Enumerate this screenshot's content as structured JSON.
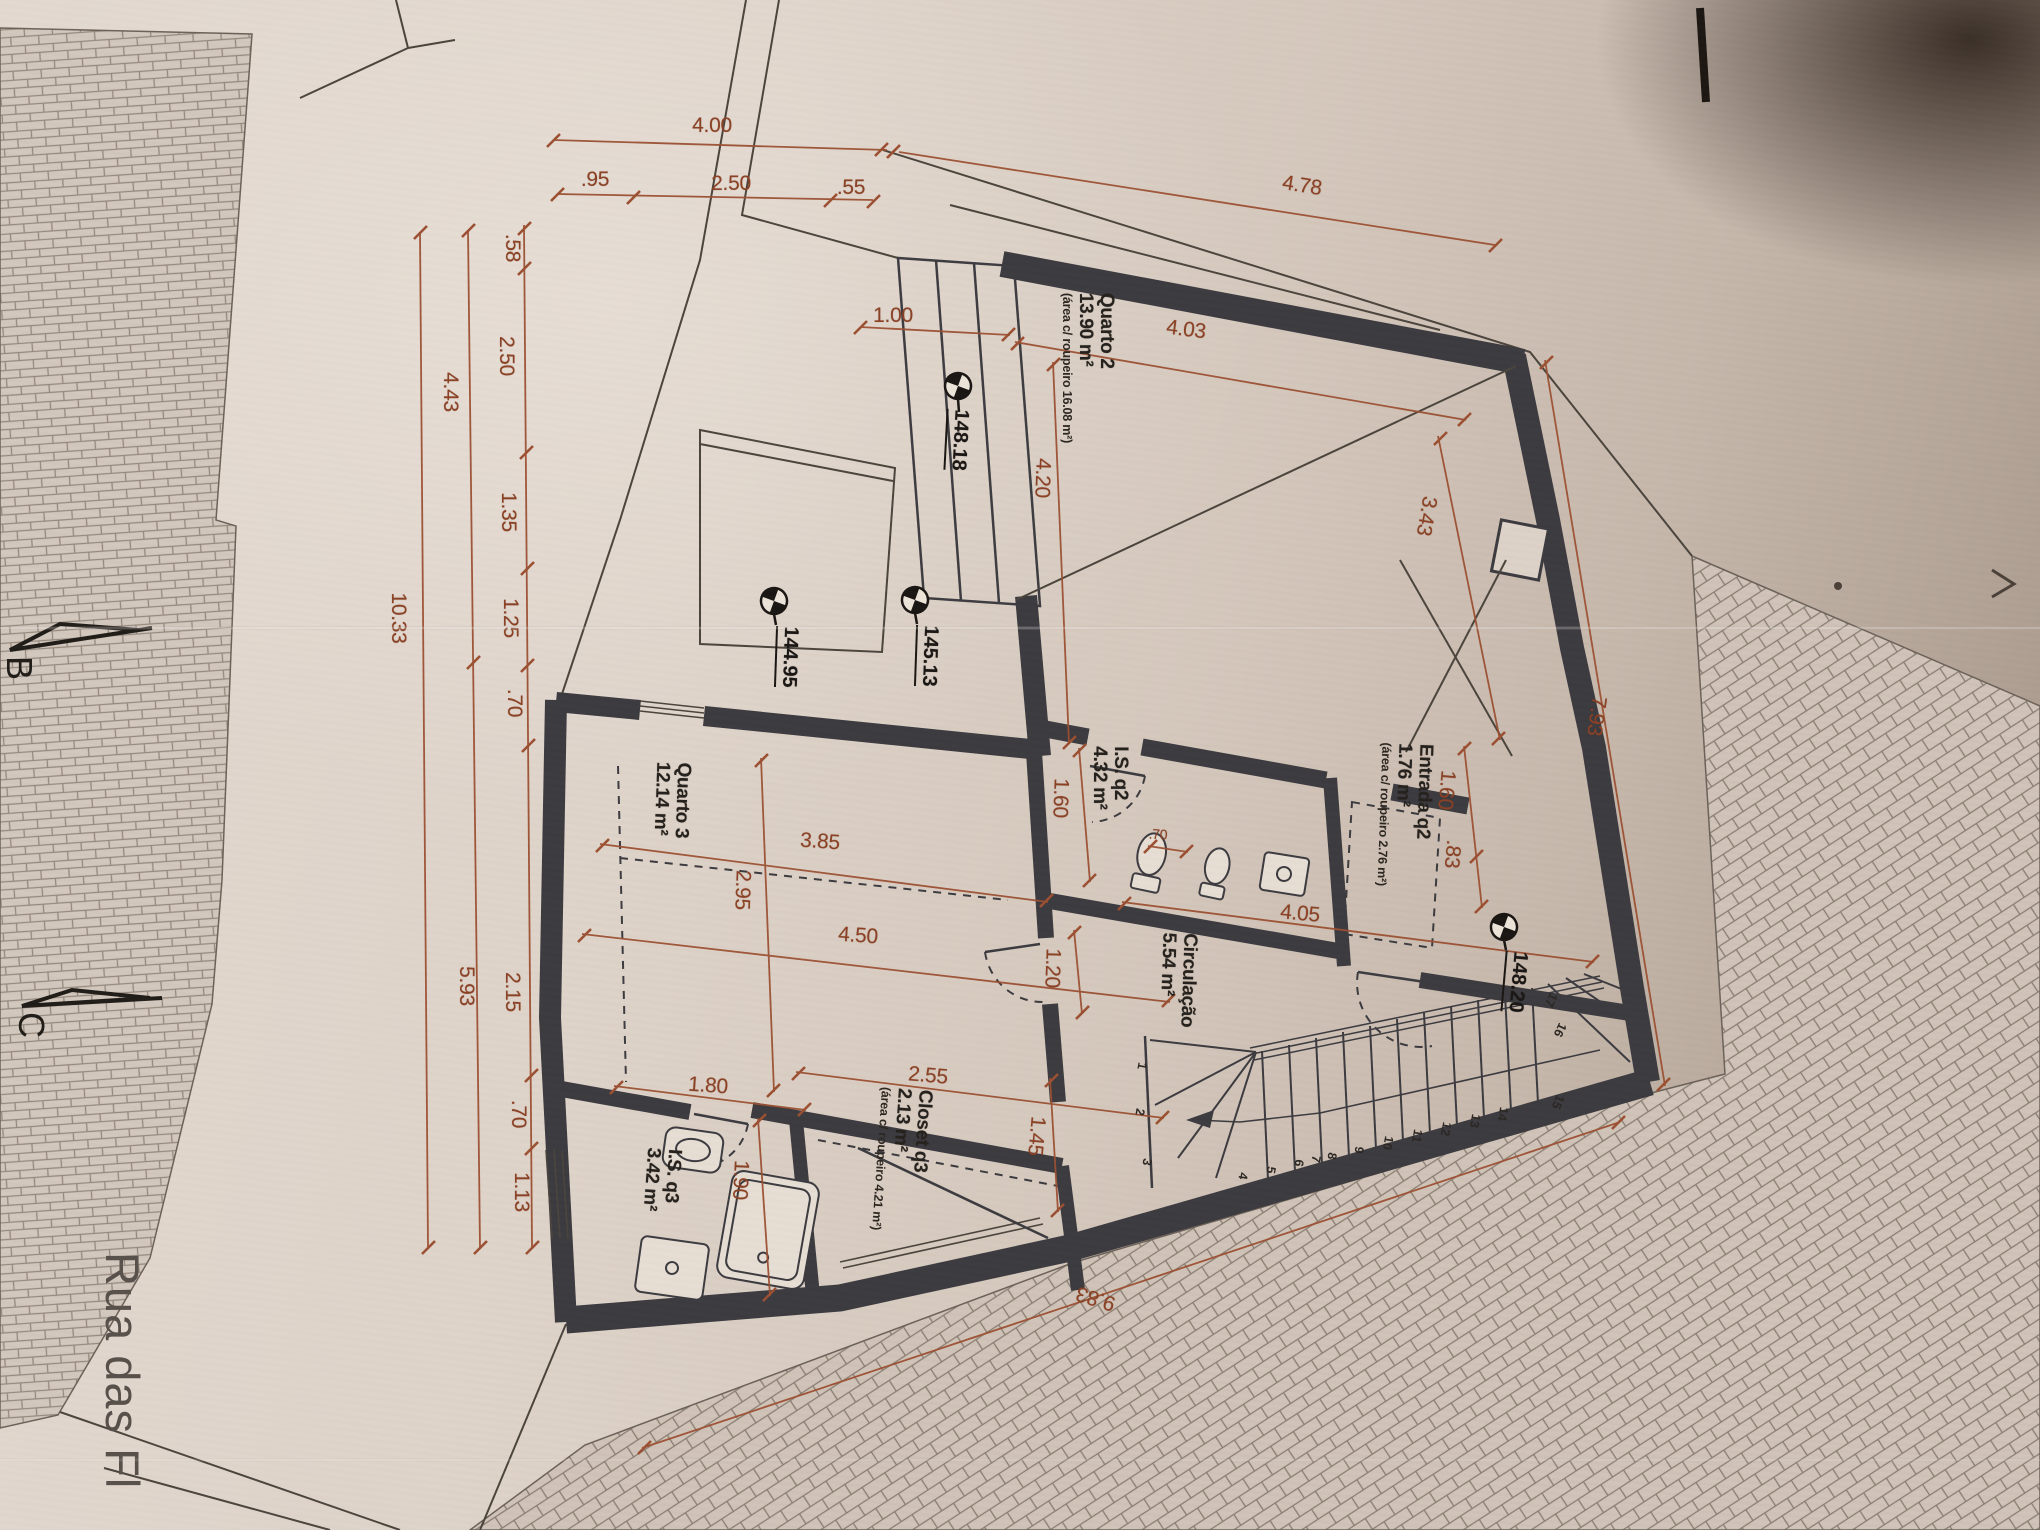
{
  "plan": {
    "street": {
      "label": "Rua das Fl"
    },
    "section_markers": [
      {
        "label": "B"
      },
      {
        "label": "C"
      }
    ],
    "rooms": [
      {
        "name": "Quarto 2",
        "area": "13.90 m²",
        "note": "(área c/ roupeiro 16.08 m²)",
        "x": 1088,
        "y": 368,
        "r": 90
      },
      {
        "name": "I.S. q2",
        "area": "4.32 m²",
        "x": 1110,
        "y": 778,
        "r": 90
      },
      {
        "name": "Entrada q2",
        "area": "1.76 m²",
        "note": "(área c/ roupeiro 2.76 m²)",
        "x": 1405,
        "y": 815,
        "r": 92
      },
      {
        "name": "Quarto 3",
        "area": "12.14 m²",
        "x": 672,
        "y": 800,
        "r": 92
      },
      {
        "name": "Circulação",
        "area": "5.54 m²",
        "x": 1178,
        "y": 980,
        "r": 92
      },
      {
        "name": "Closet q3",
        "area": "2.13 m²",
        "note": "(área c/ roupeiro 4.21 m²)",
        "x": 902,
        "y": 1160,
        "r": 94
      },
      {
        "name": "I.S. q3",
        "area": "3.42 m²",
        "x": 662,
        "y": 1180,
        "r": 94
      }
    ],
    "dimensions": [
      {
        "t": "4.00",
        "x": 712,
        "y": 126,
        "r": 0
      },
      {
        "t": ".95",
        "x": 595,
        "y": 180,
        "r": 0
      },
      {
        "t": "2.50",
        "x": 731,
        "y": 184,
        "r": 0
      },
      {
        "t": ".55",
        "x": 851,
        "y": 188,
        "r": 0
      },
      {
        "t": "4.78",
        "x": 1302,
        "y": 186,
        "r": 9
      },
      {
        "t": ".58",
        "x": 512,
        "y": 248,
        "r": 90
      },
      {
        "t": "2.50",
        "x": 506,
        "y": 356,
        "r": 90
      },
      {
        "t": "1.35",
        "x": 508,
        "y": 512,
        "r": 90
      },
      {
        "t": "1.25",
        "x": 510,
        "y": 618,
        "r": 90
      },
      {
        "t": ".70",
        "x": 514,
        "y": 703,
        "r": 90
      },
      {
        "t": "2.15",
        "x": 512,
        "y": 992,
        "r": 90
      },
      {
        "t": ".70",
        "x": 518,
        "y": 1114,
        "r": 90
      },
      {
        "t": "1.13",
        "x": 521,
        "y": 1192,
        "r": 90
      },
      {
        "t": "4.43",
        "x": 450,
        "y": 392,
        "r": 90
      },
      {
        "t": "5.93",
        "x": 466,
        "y": 986,
        "r": 90
      },
      {
        "t": "10.33",
        "x": 398,
        "y": 618,
        "r": 90
      },
      {
        "t": "1.00",
        "x": 893,
        "y": 316,
        "r": 0
      },
      {
        "t": "4.03",
        "x": 1186,
        "y": 330,
        "r": 7
      },
      {
        "t": "4.20",
        "x": 1042,
        "y": 478,
        "r": 92
      },
      {
        "t": "3.43",
        "x": 1426,
        "y": 516,
        "r": 100
      },
      {
        "t": "7.93",
        "x": 1596,
        "y": 716,
        "r": 98
      },
      {
        "t": "1.60",
        "x": 1446,
        "y": 790,
        "r": 95
      },
      {
        "t": ".83",
        "x": 1452,
        "y": 854,
        "r": 95
      },
      {
        "t": "1.60",
        "x": 1060,
        "y": 798,
        "r": 92
      },
      {
        "t": "3.85",
        "x": 820,
        "y": 842,
        "r": 4
      },
      {
        "t": "2.95",
        "x": 742,
        "y": 890,
        "r": 92
      },
      {
        "t": "4.50",
        "x": 858,
        "y": 936,
        "r": 4
      },
      {
        "t": "1.20",
        "x": 1052,
        "y": 968,
        "r": 92
      },
      {
        "t": "4.05",
        "x": 1300,
        "y": 914,
        "r": 5
      },
      {
        "t": ".70",
        "x": 1158,
        "y": 834,
        "r": 3,
        "s": 14
      },
      {
        "t": "2.55",
        "x": 928,
        "y": 1076,
        "r": 5
      },
      {
        "t": "1.45",
        "x": 1036,
        "y": 1136,
        "r": 95
      },
      {
        "t": "1.80",
        "x": 708,
        "y": 1086,
        "r": 4
      },
      {
        "t": "1.90",
        "x": 740,
        "y": 1180,
        "r": 93
      },
      {
        "t": "9.83",
        "x": 1096,
        "y": 1298,
        "r": 197
      }
    ],
    "elevation_markers": [
      {
        "t": "148.18",
        "x": 958,
        "y": 440,
        "r": 93
      },
      {
        "t": "145.13",
        "x": 928,
        "y": 656,
        "r": 92
      },
      {
        "t": "144.95",
        "x": 788,
        "y": 657,
        "r": 92
      },
      {
        "t": "148.20",
        "x": 1516,
        "y": 982,
        "r": 95
      }
    ],
    "stair_steps": [
      {
        "t": "1",
        "x": 1142,
        "y": 1066,
        "r": 100
      },
      {
        "t": "2",
        "x": 1140,
        "y": 1112,
        "r": 100
      },
      {
        "t": "3",
        "x": 1147,
        "y": 1162,
        "r": 100
      },
      {
        "t": "4",
        "x": 1243,
        "y": 1176,
        "r": 100
      },
      {
        "t": "5",
        "x": 1271,
        "y": 1170,
        "r": 100
      },
      {
        "t": "6",
        "x": 1299,
        "y": 1163,
        "r": 100
      },
      {
        "t": "7",
        "x": 1316,
        "y": 1159,
        "r": 100
      },
      {
        "t": "8",
        "x": 1332,
        "y": 1156,
        "r": 100
      },
      {
        "t": "9",
        "x": 1359,
        "y": 1150,
        "r": 100
      },
      {
        "t": "10",
        "x": 1388,
        "y": 1143,
        "r": 100
      },
      {
        "t": "11",
        "x": 1417,
        "y": 1136,
        "r": 100
      },
      {
        "t": "12",
        "x": 1446,
        "y": 1129,
        "r": 100
      },
      {
        "t": "13",
        "x": 1475,
        "y": 1121,
        "r": 100
      },
      {
        "t": "14",
        "x": 1503,
        "y": 1114,
        "r": 100
      },
      {
        "t": "15",
        "x": 1558,
        "y": 1102,
        "r": 112
      },
      {
        "t": "16",
        "x": 1560,
        "y": 1030,
        "r": 115
      },
      {
        "t": "17",
        "x": 1551,
        "y": 1000,
        "r": 115
      }
    ]
  }
}
